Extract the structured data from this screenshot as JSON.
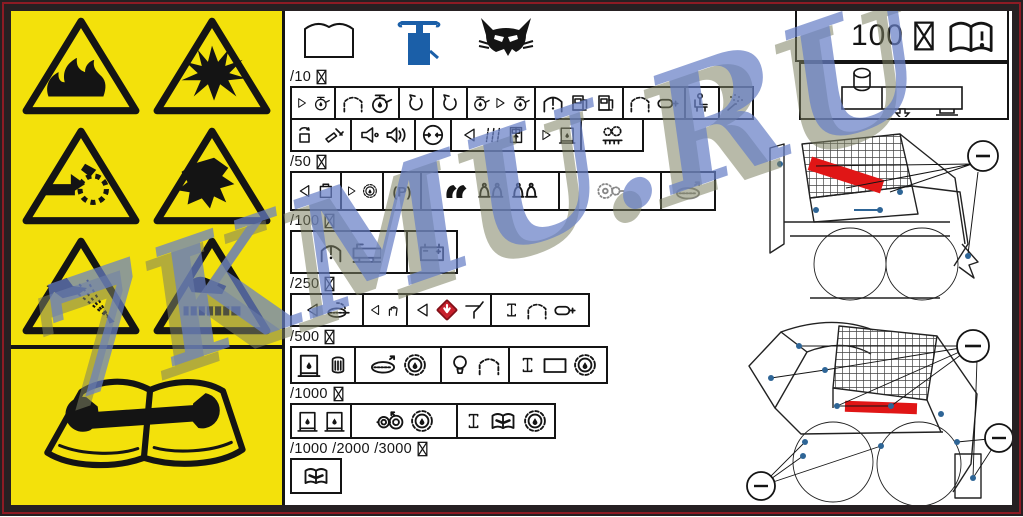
{
  "watermark": {
    "text": "7KMU.RU"
  },
  "colors": {
    "panel_yellow": "#f3e10b",
    "line_black": "#141414",
    "frame_dark": "#262022",
    "frame_red": "#8c1b24",
    "watermark_blue": "rgba(104,128,198,0.72)",
    "watermark_shadow": "rgba(125,130,98,0.55)",
    "grease_gun_blue": "#1b5fa8",
    "highlight_red": "#e01616",
    "grease_point_blue": "#2e6596",
    "wedge_red": "#c8202c"
  },
  "header_icons": [
    "operator-manual-book-icon",
    "grease-gun-icon",
    "bobcat-logo-icon"
  ],
  "hours_box": {
    "value": "100",
    "icons": [
      "hourglass-icon",
      "manual-book-exclamation-icon"
    ]
  },
  "left_panel": {
    "warnings": [
      "fire-hazard",
      "explosion-hazard",
      "entanglement-hazard",
      "crush-hazard",
      "fluid-injection-hazard",
      "hot-surface-hazard"
    ],
    "manual_symbol": "read-service-manual"
  },
  "right_panel": {
    "diagrams": [
      "reservoir-drain-diagram",
      "skid-steer-grease-points-upper",
      "skid-steer-grease-points-lower"
    ]
  },
  "intervals": [
    {
      "label": "/10",
      "lines": [
        {
          "h": 34,
          "cells": [
            {
              "name": "check-engine-oil",
              "icons": [
                "check-arrow",
                "oil-can"
              ],
              "w": 46
            },
            {
              "name": "engine-oil-level",
              "icons": [
                "canopy",
                "oil-can"
              ],
              "w": 66
            },
            {
              "name": "coolant-level",
              "icons": [
                "jug"
              ],
              "w": 36
            },
            {
              "name": "coolant-fill",
              "icons": [
                "jug"
              ],
              "w": 36
            },
            {
              "name": "oil-transfer-check",
              "icons": [
                "oil-can",
                "check-arrow",
                "oil-can"
              ],
              "w": 70
            },
            {
              "name": "fuel-level",
              "icons": [
                "canopy-excl",
                "fuel-pump",
                "fuel-pump"
              ],
              "w": 90
            },
            {
              "name": "air-cleaner",
              "icons": [
                "canopy",
                "capsule"
              ],
              "w": 64
            },
            {
              "name": "seat-belt",
              "icons": [
                "seat"
              ],
              "w": 36
            },
            {
              "name": "seat-bar-pivots",
              "icons": [
                "spray"
              ],
              "w": 36
            }
          ]
        },
        {
          "h": 34,
          "cells": [
            {
              "name": "clean-debris",
              "icons": [
                "bin-arrows",
                "scraper"
              ],
              "w": 62
            },
            {
              "name": "horn-backup-alarm",
              "icons": [
                "horn",
                "speaker"
              ],
              "w": 66
            },
            {
              "name": "tire-pressure",
              "icons": [
                "tire"
              ],
              "w": 38
            },
            {
              "name": "inspect-panels-door",
              "icons": [
                "inspect",
                "panels",
                "door"
              ],
              "w": 86
            },
            {
              "name": "fill-hydraulic-oil",
              "icons": [
                "check-arrow",
                "oil-box"
              ],
              "w": 48
            },
            {
              "name": "clean-radiator",
              "icons": [
                "radiator"
              ],
              "w": 64
            }
          ]
        }
      ]
    },
    {
      "label": "/50",
      "lines": [
        {
          "h": 40,
          "cells": [
            {
              "name": "inspect-battery-box",
              "icons": [
                "inspect",
                "battery-box"
              ],
              "w": 52
            },
            {
              "name": "chaincase-oil",
              "icons": [
                "check-arrow",
                "gear-droplet"
              ],
              "w": 44
            },
            {
              "name": "parking-brake-test",
              "icons": [
                "parking"
              ],
              "w": 40
            },
            {
              "name": "grease-pivot-points",
              "icons": [
                "gloves",
                "bells",
                "bells"
              ],
              "w": 140
            },
            {
              "name": "drive-sprocket",
              "icons": [
                "sprocket"
              ],
              "w": 104,
              "faint": true
            },
            {
              "name": "track-tension",
              "icons": [
                "track"
              ],
              "w": 56,
              "faint": true
            }
          ]
        }
      ]
    },
    {
      "label": "/100",
      "lines": [
        {
          "h": 44,
          "cells": [
            {
              "name": "hydraulic-fluid-reservoir",
              "icons": [
                "canopy-excl",
                "h-tank"
              ],
              "w": 118
            },
            {
              "name": "battery-service",
              "icons": [
                "battery"
              ],
              "w": 52
            }
          ]
        }
      ]
    },
    {
      "label": "/250",
      "lines": [
        {
          "h": 34,
          "cells": [
            {
              "name": "inspect-spark-arrestor",
              "icons": [
                "inspect",
                "muffler"
              ],
              "w": 74
            },
            {
              "name": "inspect-lift-arm",
              "icons": [
                "inspect",
                "hand-part"
              ],
              "w": 46
            },
            {
              "name": "inspect-bobtach-wedge",
              "icons": [
                "inspect",
                "red-diamond",
                "funnel"
              ],
              "w": 86
            },
            {
              "name": "axle-air-cleaner",
              "icons": [
                "ibeam",
                "canopy",
                "capsule"
              ],
              "w": 100
            }
          ]
        }
      ]
    },
    {
      "label": "/500",
      "lines": [
        {
          "h": 38,
          "cells": [
            {
              "name": "replace-oil-filter",
              "icons": [
                "oil-box",
                "cylinder-filter"
              ],
              "w": 66
            },
            {
              "name": "track-filter-service",
              "icons": [
                "track",
                "gear-droplet"
              ],
              "w": 88
            },
            {
              "name": "bulb-cab-check",
              "icons": [
                "bulb",
                "canopy"
              ],
              "w": 70
            },
            {
              "name": "axle-box-filter",
              "icons": [
                "ibeam",
                "box",
                "gear-droplet"
              ],
              "w": 100
            }
          ]
        }
      ]
    },
    {
      "label": "/1000",
      "lines": [
        {
          "h": 36,
          "cells": [
            {
              "name": "replace-oils",
              "icons": [
                "oil-box",
                "oil-box"
              ],
              "w": 62
            },
            {
              "name": "axle-wheel-filter",
              "icons": [
                "axle-wheels",
                "gear-droplet"
              ],
              "w": 108
            },
            {
              "name": "axle-manual-filter",
              "icons": [
                "ibeam",
                "book-small",
                "gear-droplet"
              ],
              "w": 100
            }
          ]
        }
      ]
    },
    {
      "label": "/1000 /2000 /3000",
      "lines": [
        {
          "h": 36,
          "cells": [
            {
              "name": "see-service-manual",
              "icons": [
                "book-small"
              ],
              "w": 52
            }
          ]
        }
      ]
    }
  ]
}
